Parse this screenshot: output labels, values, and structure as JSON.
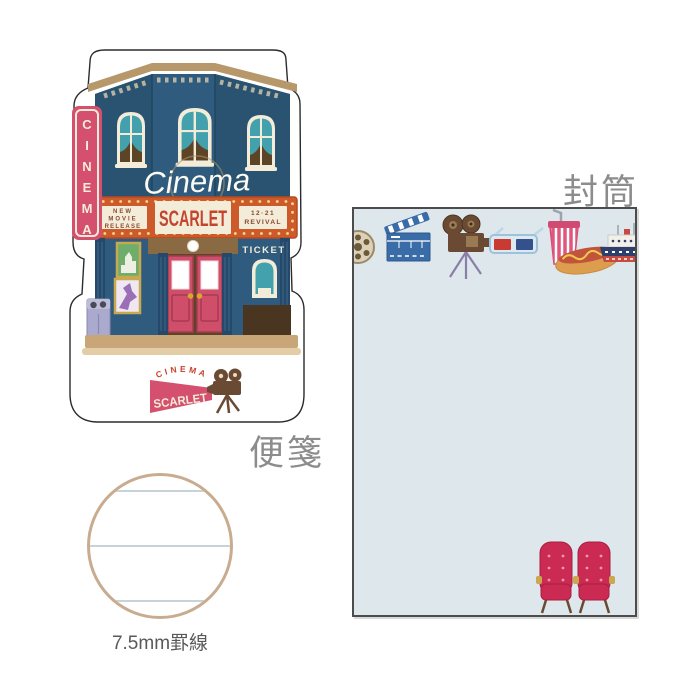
{
  "product": {
    "letter_paper": {
      "label": "便箋",
      "vertical_sign": {
        "letters": [
          "C",
          "I",
          "N",
          "E",
          "M",
          "A"
        ]
      },
      "script_sign": "Cinema",
      "marquee": {
        "left_lines": [
          "NEW",
          "MOVIE",
          "RELEASE"
        ],
        "title": "SCARLET",
        "right_lines": [
          "12·21",
          "REVIVAL"
        ]
      },
      "ticket_sign": "TICKET",
      "logo": {
        "arc_text": "CINEMA",
        "name": "SCARLET"
      }
    },
    "envelope": {
      "label": "封筒",
      "icons": [
        "film-reel",
        "clapperboard",
        "movie-camera",
        "3d-glasses",
        "drink-cup",
        "hot-dog",
        "boat",
        "cinema-seats"
      ]
    },
    "ruling": {
      "label": "7.5mm罫線"
    }
  },
  "colors": {
    "building_navy": "#2f5c7e",
    "building_navy_dark": "#2a5372",
    "window_teal": "#43a1ad",
    "cream": "#f3ecd8",
    "tan_cornice": "#b7986a",
    "marquee_orange": "#cd5a2a",
    "marquee_bulb": "#f2d98c",
    "sign_pink": "#d4506e",
    "door_pink": "#cf4f6b",
    "text_red": "#c4452e",
    "brown": "#6b4a33",
    "envelope_blue": "#dde7ec",
    "seat_crimson": "#cb2a52",
    "label_gray": "#8c8c8c"
  }
}
